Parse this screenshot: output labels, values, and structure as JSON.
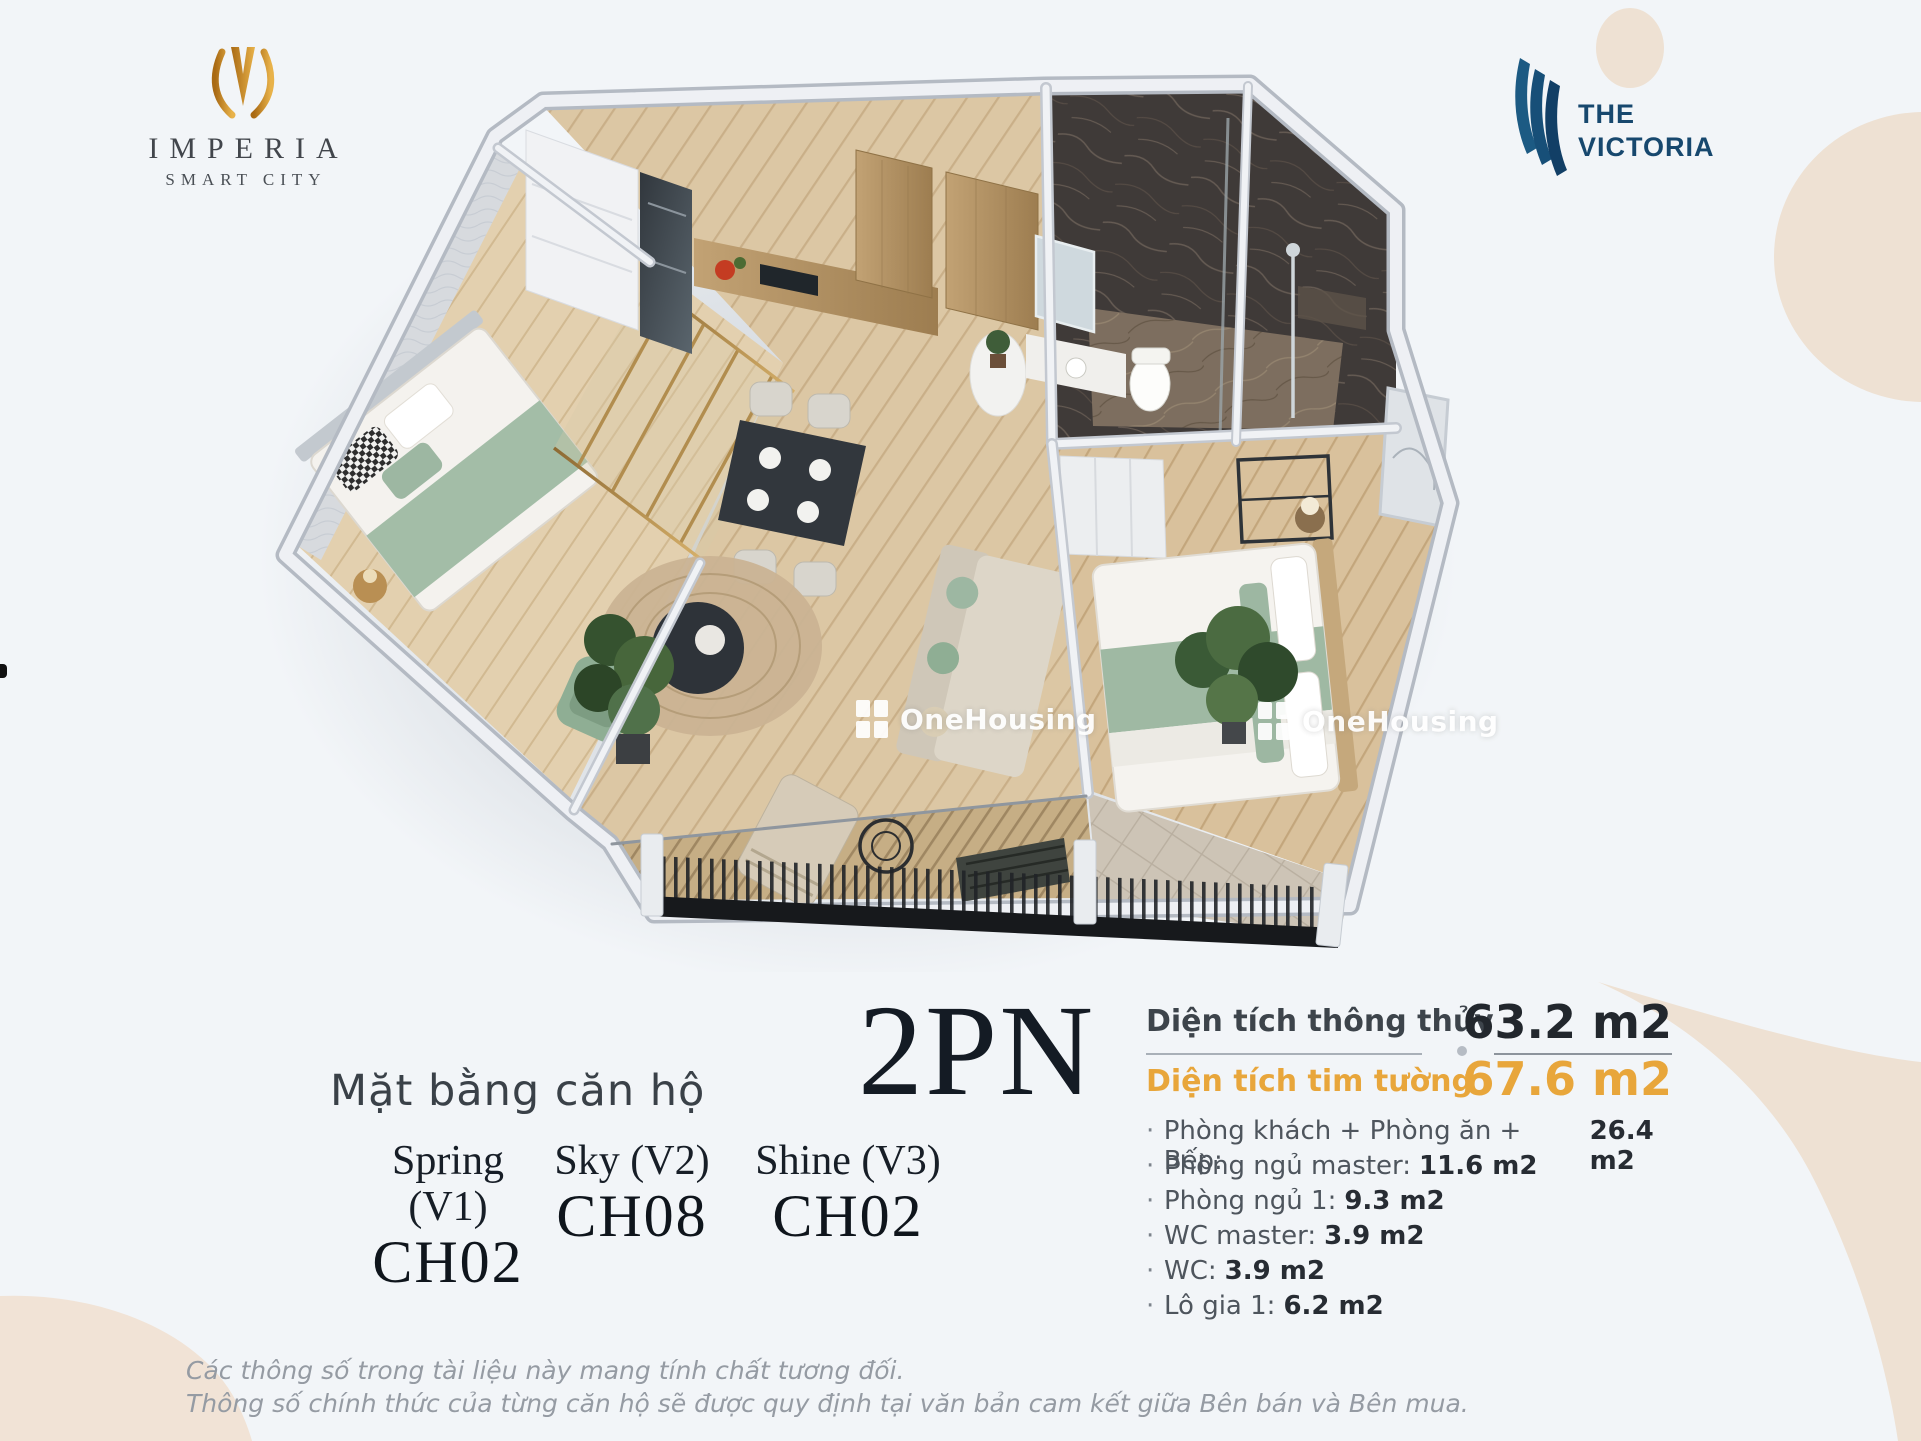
{
  "colors": {
    "background": "#f2f5f8",
    "blob": "#eee1d3",
    "imperia-gold": "#c9891f",
    "imperia-text": "#42464c",
    "victoria-blue": "#17486e",
    "title-dark": "#141b24",
    "area-gold": "#e8a63b",
    "watermark": "#ffffff",
    "bed-green": "#9db7a2",
    "wood-floor": "#dcc7a4",
    "marble-dark": "#3f3a38"
  },
  "brand": {
    "imperia": {
      "name": "IMPERIA",
      "tagline": "SMART CITY",
      "icon": "imperia-tulip-icon"
    },
    "victoria": {
      "line1": "THE",
      "line2": "VICTORIA",
      "icon": "victoria-stripes-icon"
    }
  },
  "watermark": {
    "text": "OneHousing",
    "icon": "onehousing-window-icon"
  },
  "title": {
    "label": "Mặt bằng căn hộ",
    "value": "2PN"
  },
  "variants": [
    {
      "name": "Spring (V1)",
      "unit": "CH02"
    },
    {
      "name": "Sky (V2)",
      "unit": "CH08"
    },
    {
      "name": "Shine (V3)",
      "unit": "CH02"
    }
  ],
  "areas": {
    "clear": {
      "label": "Diện tích thông thủy",
      "value": "63.2 m2"
    },
    "gross": {
      "label": "Diện tích tim tường",
      "value": "67.6 m2"
    }
  },
  "bullet": "·",
  "rooms": [
    {
      "label": "Phòng khách + Phòng ăn + Bếp:",
      "value": "26.4 m2"
    },
    {
      "label": "Phòng ngủ master:",
      "value": "11.6 m2"
    },
    {
      "label": "Phòng ngủ 1:",
      "value": "9.3 m2"
    },
    {
      "label": "WC master:",
      "value": "3.9 m2"
    },
    {
      "label": "WC:",
      "value": "3.9 m2"
    },
    {
      "label": "Lô gia 1:",
      "value": "6.2 m2"
    }
  ],
  "disclaimer": [
    "Các thông số trong tài liệu này mang tính chất tương đối.",
    "Thông số chính thức của từng căn hộ sẽ được quy định tại văn bản cam kết giữa Bên bán và Bên mua."
  ]
}
